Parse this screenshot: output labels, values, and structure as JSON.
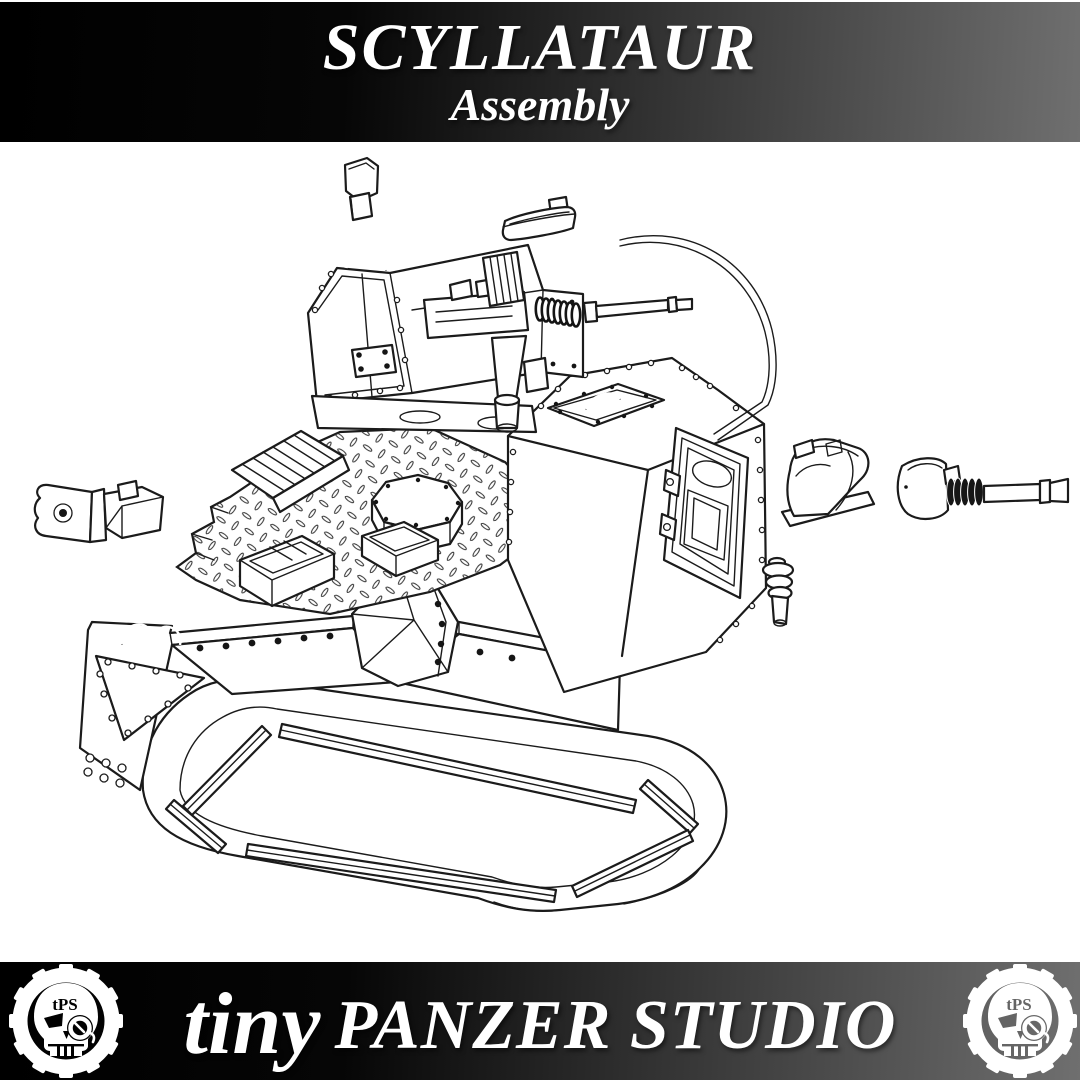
{
  "header": {
    "title": "SCYLLATAUR",
    "subtitle": "Assembly"
  },
  "footer": {
    "brand_prefix": "tiny",
    "brand_name": "PANZER STUDIO",
    "logo_monogram": "tPS"
  },
  "colors": {
    "banner_dark": "#000000",
    "banner_light": "#6f6f6f",
    "line_art": "#1b1b1b",
    "canvas": "#ffffff"
  },
  "icons": {
    "footer_left_logo": "gear-skull-monogram",
    "footer_right_logo": "gear-skull-monogram"
  }
}
